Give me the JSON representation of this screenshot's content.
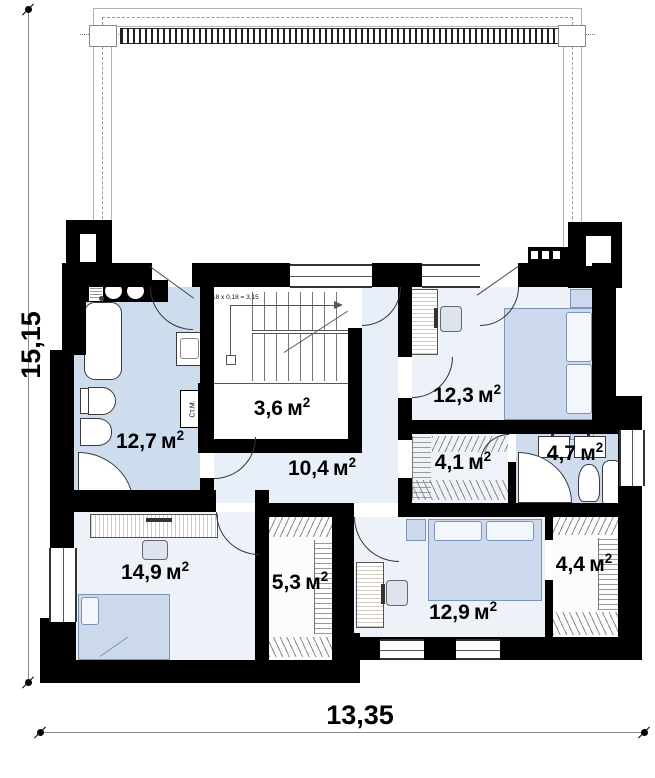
{
  "plan": {
    "rooms": [
      {
        "name": "bathroom-upper-left",
        "value": "12,7",
        "unit": "м",
        "sup": "2"
      },
      {
        "name": "stair-storage",
        "value": "3,6",
        "unit": "м",
        "sup": "2"
      },
      {
        "name": "hallway",
        "value": "10,4",
        "unit": "м",
        "sup": "2"
      },
      {
        "name": "bedroom-upper-right",
        "value": "12,3",
        "unit": "м",
        "sup": "2"
      },
      {
        "name": "wardrobe-upper",
        "value": "4,1",
        "unit": "м",
        "sup": "2"
      },
      {
        "name": "bathroom-right",
        "value": "4,7",
        "unit": "м",
        "sup": "2"
      },
      {
        "name": "bedroom-lower-left",
        "value": "14,9",
        "unit": "м",
        "sup": "2"
      },
      {
        "name": "wardrobe-middle",
        "value": "5,3",
        "unit": "м",
        "sup": "2"
      },
      {
        "name": "bedroom-lower-right",
        "value": "12,9",
        "unit": "м",
        "sup": "2"
      },
      {
        "name": "wardrobe-lower-right",
        "value": "4,4",
        "unit": "м",
        "sup": "2"
      }
    ],
    "stair_note": "18 x 0,18 = 3,15",
    "washing_machine_label": "Ст.М.",
    "dimensions": {
      "height": "15,15",
      "width": "13,35"
    },
    "colors": {
      "wall": "#000000",
      "bath_fill": "#cdddee",
      "room_fill": "#edf2f9",
      "hall_fill": "#e9eff8",
      "furniture_fill": "#ccd9ec"
    }
  }
}
